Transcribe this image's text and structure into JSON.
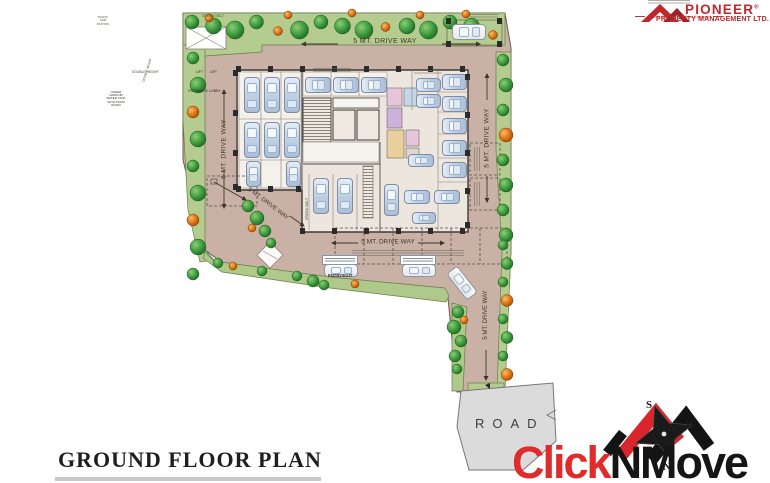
{
  "page": {
    "title": "GROUND FLOOR PLAN"
  },
  "plan": {
    "driveway_label": "5 MT. DRIVE WAY",
    "road": "ROAD",
    "entry_exit": "ENTRY/EXIT",
    "green_belt": "GREEN BELT",
    "lift": "LIFT",
    "entrance_lobby": "ENTRANCE LOBBY",
    "double_height": "DOUBLE HEIGHT",
    "water_tank": "UNDER GROUND WATER TANK WITH PUMP ROOM",
    "substation": "TRANS. SUB STATION"
  },
  "branding": {
    "pioneer_name": "PIONEER",
    "pioneer_reg": "®",
    "pioneer_sub": "PROPERTY MANAGEMENT LTD.",
    "pioneer_tagline": "An ISO 9001:2015 Certified Company",
    "cnm_part1": "Click",
    "cnm_part2": "NMove"
  },
  "compass": {
    "top": "S",
    "right": "W",
    "bottom": "N"
  },
  "colors": {
    "ground": "#c9b2a5",
    "green_belt": "#b4cc90",
    "road": "#dbdbdb",
    "pioneer_red": "#c0272d",
    "clicknmove_red": "#e02b2b"
  }
}
